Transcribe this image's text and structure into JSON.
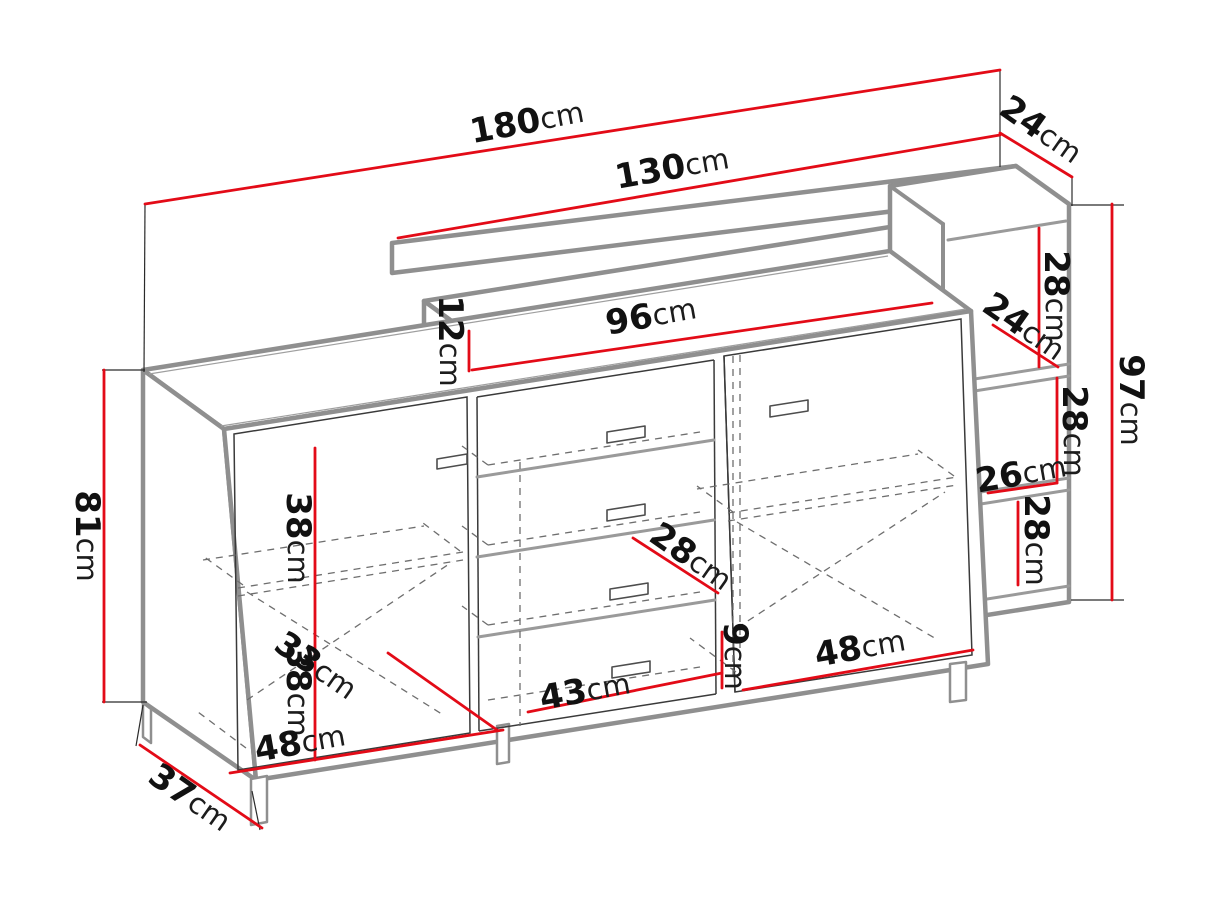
{
  "colors": {
    "dimension_line": "#e30b17",
    "structure_edge": "#8f8f8f",
    "label_text": "#111111",
    "background": "#ffffff"
  },
  "dimensions": {
    "d180": {
      "value": "180",
      "unit": "cm"
    },
    "d130": {
      "value": "130",
      "unit": "cm"
    },
    "d24a": {
      "value": "24",
      "unit": "cm"
    },
    "d96": {
      "value": "96",
      "unit": "cm"
    },
    "d12": {
      "value": "12",
      "unit": "cm"
    },
    "d28a": {
      "value": "28",
      "unit": "cm"
    },
    "d24b": {
      "value": "24",
      "unit": "cm"
    },
    "d97": {
      "value": "97",
      "unit": "cm"
    },
    "d28b": {
      "value": "28",
      "unit": "cm"
    },
    "d26": {
      "value": "26",
      "unit": "cm"
    },
    "d28c": {
      "value": "28",
      "unit": "cm"
    },
    "d81": {
      "value": "81",
      "unit": "cm"
    },
    "d38a": {
      "value": "38",
      "unit": "cm"
    },
    "d38b": {
      "value": "38",
      "unit": "cm"
    },
    "d33": {
      "value": "33",
      "unit": "cm"
    },
    "d48a": {
      "value": "48",
      "unit": "cm"
    },
    "d37": {
      "value": "37",
      "unit": "cm"
    },
    "d43": {
      "value": "43",
      "unit": "cm"
    },
    "d28d": {
      "value": "28",
      "unit": "cm"
    },
    "d9": {
      "value": "9",
      "unit": "cm"
    },
    "d48b": {
      "value": "48",
      "unit": "cm"
    }
  }
}
